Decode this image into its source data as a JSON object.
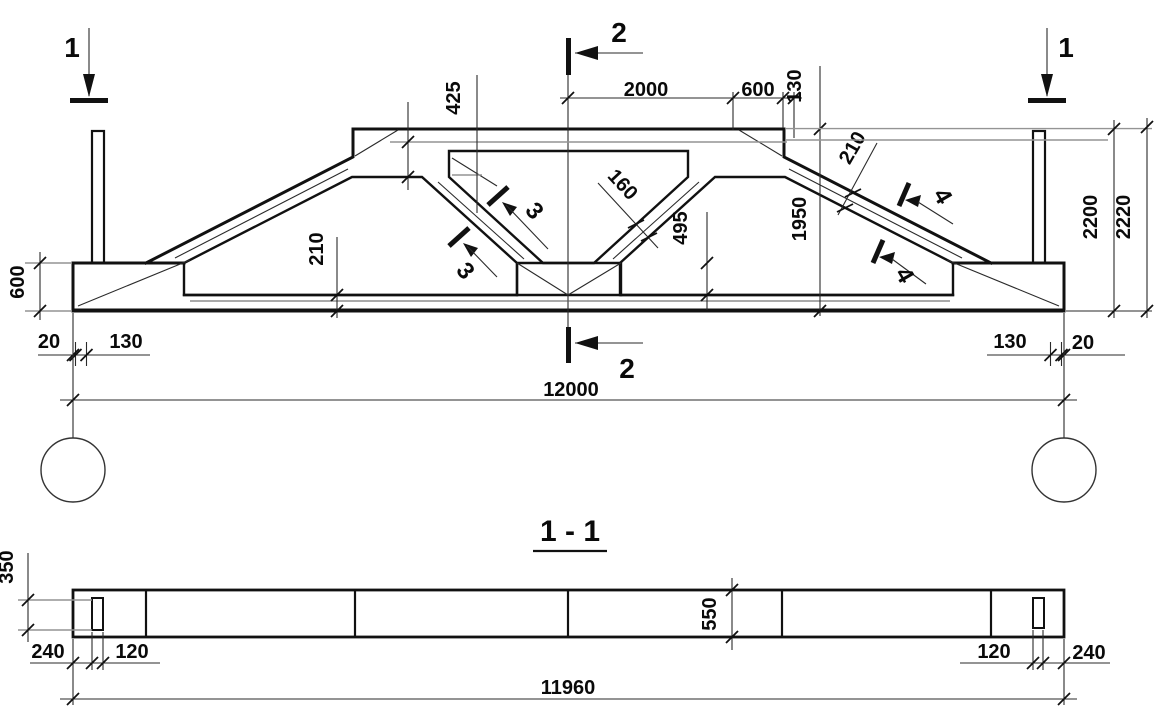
{
  "elevation": {
    "section_marks": {
      "mark1": "1",
      "mark2": "2",
      "mark3": "3",
      "mark4": "4"
    },
    "dims": {
      "d425": "425",
      "d2000": "2000",
      "d600_top": "600",
      "d130_top": "130",
      "d210_slope": "210",
      "d1950": "1950",
      "d2200": "2200",
      "d2220": "2220",
      "d160": "160",
      "d495": "495",
      "d210_chord": "210",
      "d600_end": "600",
      "d20_left": "20",
      "d130_left": "130",
      "d130_right": "130",
      "d20_right": "20",
      "d12000": "12000"
    }
  },
  "section_1_1": {
    "title": "1 - 1",
    "dims": {
      "d350": "350",
      "d240_left": "240",
      "d120_left": "120",
      "d550": "550",
      "d120_right": "120",
      "d240_right": "240",
      "d11960": "11960"
    }
  }
}
